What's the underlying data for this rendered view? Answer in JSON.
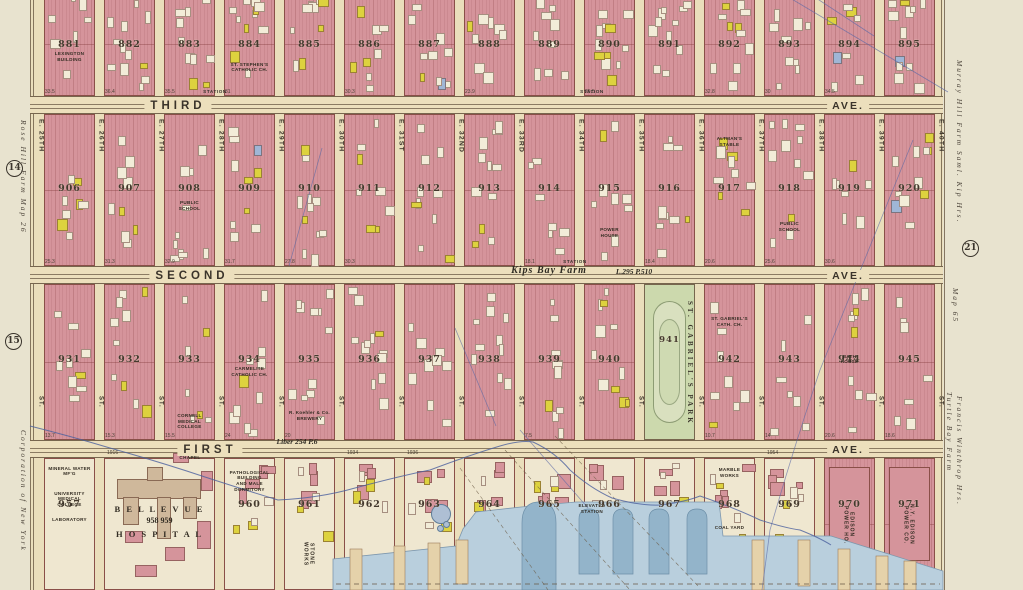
{
  "palette": {
    "block_pink": "#d5949b",
    "frame_yellow": "#ddd23e",
    "park_green": "#ccd9ad",
    "water": "#b9cfdd",
    "water_deep": "#93b4ca",
    "pier_tan": "#e5d2aa",
    "paper": "#e8e3cf",
    "ground": "#eadebb",
    "ink": "#3a332a",
    "block_outline": "#8a4f48",
    "survey_blue": "#5b68a6"
  },
  "margins": {
    "left": {
      "top_text": "Rose Hill Farm Map 26",
      "bottom_text": "Corporation of New York",
      "circle_top": "14",
      "circle_bottom": "15"
    },
    "right": {
      "top_text": "Murray Hill Farm  Saml. Kip Hrs.",
      "circle": "21",
      "mid_text": "Map 65",
      "bottom_text_1": "Turtle Bay Farm",
      "bottom_text_2": "Francis Winthrop Hrs."
    }
  },
  "street_suffix_label": "ST.",
  "streets": [
    {
      "label": "E. 25TH"
    },
    {
      "label": "E. 26TH"
    },
    {
      "label": "E. 27TH"
    },
    {
      "label": "E. 28TH"
    },
    {
      "label": "E. 29TH"
    },
    {
      "label": "E. 30TH"
    },
    {
      "label": "E. 31ST"
    },
    {
      "label": "E. 32ND"
    },
    {
      "label": "E. 33RD"
    },
    {
      "label": "E. 34TH"
    },
    {
      "label": "E. 35TH"
    },
    {
      "label": "E. 36TH"
    },
    {
      "label": "E. 37TH"
    },
    {
      "label": "E. 38TH"
    },
    {
      "label": "E. 39TH"
    },
    {
      "label": "E. 40TH"
    }
  ],
  "avenues": [
    {
      "name": "THIRD",
      "right_label": "AVE.",
      "stations": [
        "STATION",
        "STATION"
      ],
      "dims": [
        {
          "col": 0,
          "v": "33.5"
        },
        {
          "col": 1,
          "v": "36.4"
        },
        {
          "col": 2,
          "v": "35.5"
        },
        {
          "col": 3,
          "v": "31"
        },
        {
          "col": 5,
          "v": "30.3"
        },
        {
          "col": 7,
          "v": "23.9"
        },
        {
          "col": 9,
          "v": "25.5"
        },
        {
          "col": 11,
          "v": "32.8"
        },
        {
          "col": 12,
          "v": "30"
        },
        {
          "col": 13,
          "v": "34.5"
        }
      ]
    },
    {
      "name": "SECOND",
      "right_label": "AVE.",
      "stations": [
        "STATION"
      ],
      "dims": [
        {
          "col": 0,
          "v": "25.3"
        },
        {
          "col": 1,
          "v": "31.3"
        },
        {
          "col": 2,
          "v": "32.9"
        },
        {
          "col": 3,
          "v": "31.7"
        },
        {
          "col": 4,
          "v": "27.8"
        },
        {
          "col": 5,
          "v": "30.3"
        },
        {
          "col": 8,
          "v": "18.1"
        },
        {
          "col": 10,
          "v": "18.4"
        },
        {
          "col": 11,
          "v": "20.6"
        },
        {
          "col": 12,
          "v": "25.6"
        },
        {
          "col": 13,
          "v": "30.6"
        }
      ]
    },
    {
      "name": "FIRST",
      "right_label": "AVE.",
      "stations": [],
      "dims": [
        {
          "col": 0,
          "v": "13.7"
        },
        {
          "col": 1,
          "v": "15.3"
        },
        {
          "col": 2,
          "v": "15.5"
        },
        {
          "col": 3,
          "v": "24"
        },
        {
          "col": 4,
          "v": "20"
        },
        {
          "col": 8,
          "v": "7.5"
        },
        {
          "col": 11,
          "v": "10.7"
        },
        {
          "col": 12,
          "v": "14"
        },
        {
          "col": 13,
          "v": "20.6"
        },
        {
          "col": 14,
          "v": "18.6"
        }
      ],
      "south_nums": [
        {
          "col": 1,
          "v": "1916"
        },
        {
          "col": 3,
          "v": "1926"
        },
        {
          "col": 5,
          "v": "1934"
        },
        {
          "col": 6,
          "v": "1936"
        },
        {
          "col": 12,
          "v": "1954"
        },
        {
          "col": 13,
          "v": "1956"
        }
      ]
    }
  ],
  "blocks": {
    "top": [
      {
        "num": "881",
        "col": 0,
        "pois": [
          {
            "t": "LEXINGTON\nBUILDING",
            "fy": 0.56
          }
        ]
      },
      {
        "num": "882",
        "col": 1
      },
      {
        "num": "883",
        "col": 2
      },
      {
        "num": "884",
        "col": 3,
        "pois": [
          {
            "t": "ST. STEPHEN'S\nCATHOLIC CH.",
            "fy": 0.66
          }
        ]
      },
      {
        "num": "885",
        "col": 4
      },
      {
        "num": "886",
        "col": 5
      },
      {
        "num": "887",
        "col": 6
      },
      {
        "num": "888",
        "col": 7
      },
      {
        "num": "889",
        "col": 8
      },
      {
        "num": "890",
        "col": 9
      },
      {
        "num": "891",
        "col": 10
      },
      {
        "num": "892",
        "col": 11
      },
      {
        "num": "893",
        "col": 12
      },
      {
        "num": "894",
        "col": 13
      },
      {
        "num": "895",
        "col": 14
      }
    ],
    "middle": [
      {
        "num": "906",
        "col": 0
      },
      {
        "num": "907",
        "col": 1
      },
      {
        "num": "908",
        "col": 2,
        "pois": [
          {
            "t": "PUBLIC\nSCHOOL",
            "fy": 0.56
          }
        ]
      },
      {
        "num": "909",
        "col": 3
      },
      {
        "num": "910",
        "col": 4
      },
      {
        "num": "911",
        "col": 5
      },
      {
        "num": "912",
        "col": 6
      },
      {
        "num": "913",
        "col": 7
      },
      {
        "num": "914",
        "col": 8
      },
      {
        "num": "915",
        "col": 9,
        "pois": [
          {
            "t": "POWER\nHOUSE",
            "fy": 0.74
          }
        ]
      },
      {
        "num": "916",
        "col": 10
      },
      {
        "num": "917",
        "col": 11,
        "pois": [
          {
            "t": "ALTMAN'S\nSTABLE",
            "fy": 0.14
          }
        ]
      },
      {
        "num": "918",
        "col": 12,
        "pois": [
          {
            "t": "PUBLIC\nSCHOOL",
            "fy": 0.7
          }
        ]
      },
      {
        "num": "919",
        "col": 13
      },
      {
        "num": "920",
        "col": 14
      }
    ],
    "third": [
      {
        "num": "931",
        "col": 0
      },
      {
        "num": "932",
        "col": 1
      },
      {
        "num": "933",
        "col": 2,
        "pois": [
          {
            "t": "CORNELL\nMEDICAL\nCOLLEGE",
            "fy": 0.82
          }
        ]
      },
      {
        "num": "934",
        "col": 3,
        "pois": [
          {
            "t": "CARMELITE\nCATHOLIC CH.",
            "fy": 0.52
          }
        ]
      },
      {
        "num": "935",
        "col": 4,
        "pois": [
          {
            "t": "R. Koehler & Co.\nBREWERY",
            "fy": 0.8
          }
        ]
      },
      {
        "num": "936",
        "col": 5
      },
      {
        "num": "937",
        "col": 6
      },
      {
        "num": "938",
        "col": 7
      },
      {
        "num": "939",
        "col": 8
      },
      {
        "num": "940",
        "col": 9
      },
      {
        "num": "941",
        "col": 10,
        "type": "park"
      },
      {
        "num": "942",
        "col": 11,
        "pois": [
          {
            "t": "ST. GABRIEL'S\nCATH. CH.",
            "fy": 0.2
          }
        ]
      },
      {
        "num": "943",
        "col": 12
      },
      {
        "num": "944",
        "col": 13,
        "pois": [
          {
            "t": "BATH\nHOUSE",
            "fy": 0.44
          }
        ]
      },
      {
        "num": "945",
        "col": 14
      }
    ],
    "bottom": [
      {
        "num": "957",
        "col": 0,
        "type": "cream",
        "pois": [
          {
            "t": "MINERAL WATER\nMF'G",
            "fy": 0.05
          },
          {
            "t": "UNIVERSITY\nMEDICAL\nCOLLEGE",
            "fy": 0.24
          },
          {
            "t": "LABORATORY",
            "fy": 0.44
          }
        ]
      },
      {
        "num": "958 959",
        "col": 1,
        "span": 2,
        "type": "hospital"
      },
      {
        "num": "960",
        "col": 3,
        "type": "cream",
        "pois": [
          {
            "t": "PATHOLOGICAL\nBUILDING\nAND MALE\nDORMITORY",
            "fy": 0.08
          }
        ]
      },
      {
        "num": "961",
        "col": 4,
        "type": "cream",
        "pois": [
          {
            "t": "STONE\nWORKS",
            "fy": 0.52,
            "vert": true
          }
        ]
      },
      {
        "num": "962",
        "col": 5,
        "type": "cream"
      },
      {
        "num": "963",
        "col": 6,
        "type": "cream",
        "tank": true
      },
      {
        "num": "964",
        "col": 7,
        "type": "cream"
      },
      {
        "num": "965",
        "col": 8,
        "type": "cream"
      },
      {
        "num": "966",
        "col": 9,
        "type": "cream"
      },
      {
        "num": "967",
        "col": 10,
        "type": "cream"
      },
      {
        "num": "968",
        "col": 11,
        "type": "cream",
        "pois": [
          {
            "t": "MARBLE\nWORKS",
            "fy": 0.06
          },
          {
            "t": "COAL YARD",
            "fy": 0.5
          }
        ]
      },
      {
        "num": "969",
        "col": 12,
        "type": "cream"
      },
      {
        "num": "970",
        "col": 13,
        "type": "power",
        "pois": [
          {
            "t": "EDISON\nPOWER HO.",
            "fy": 0.3,
            "vert": true
          }
        ]
      },
      {
        "num": "971",
        "col": 14,
        "type": "power",
        "pois": [
          {
            "t": "N.Y. EDISON\nPOWER CO.",
            "fy": 0.3,
            "vert": true
          }
        ]
      }
    ]
  },
  "park": {
    "num": "941",
    "name": "ST. GABRIEL'S PARK"
  },
  "hospital": {
    "name_top": "B E L L E V U E",
    "numbers": "958        959",
    "name_bottom": "H O S P I T A L",
    "chapel": "CHAPEL"
  },
  "annotations": [
    {
      "t": "Kips Bay Farm",
      "x": 549,
      "y": 265,
      "cls": "farm"
    },
    {
      "t": "L.295 P.510",
      "x": 634,
      "y": 267,
      "cls": "farm-sm"
    },
    {
      "t": "Liber 254 P.6",
      "x": 297,
      "y": 437,
      "cls": "farm-sm"
    },
    {
      "t": "ELEVATED\nSTATION",
      "x": 592,
      "y": 503,
      "cls": "tiny"
    },
    {
      "t": "CHAPEL",
      "x": 190,
      "y": 455,
      "cls": "tiny"
    }
  ]
}
